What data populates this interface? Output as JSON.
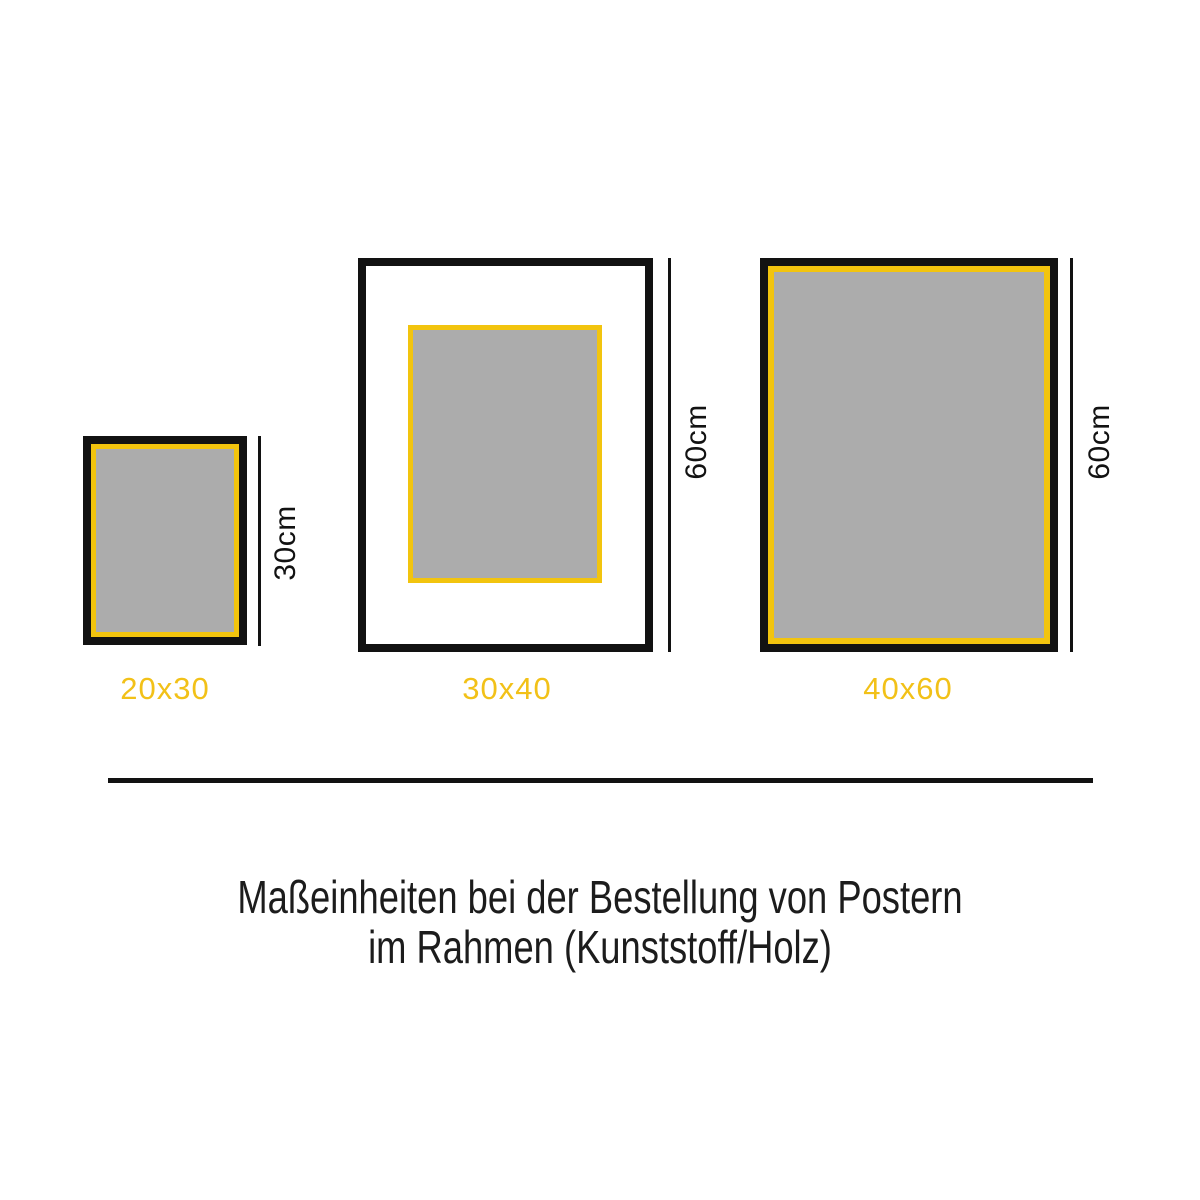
{
  "diagram": {
    "frames": [
      {
        "size_label": "20x30",
        "height_label": "30cm"
      },
      {
        "size_label": "30x40",
        "height_label": "60cm"
      },
      {
        "size_label": "40x60",
        "height_label": "60cm"
      }
    ],
    "caption_line1": "Maßeinheiten bei der Bestellung von Postern",
    "caption_line2": "im Rahmen (Kunststoff/Holz)",
    "colors": {
      "frame_black": "#121212",
      "border_yellow": "#F2C40E",
      "label_yellow": "#F2C118",
      "poster_gray": "#ACACAC"
    }
  }
}
